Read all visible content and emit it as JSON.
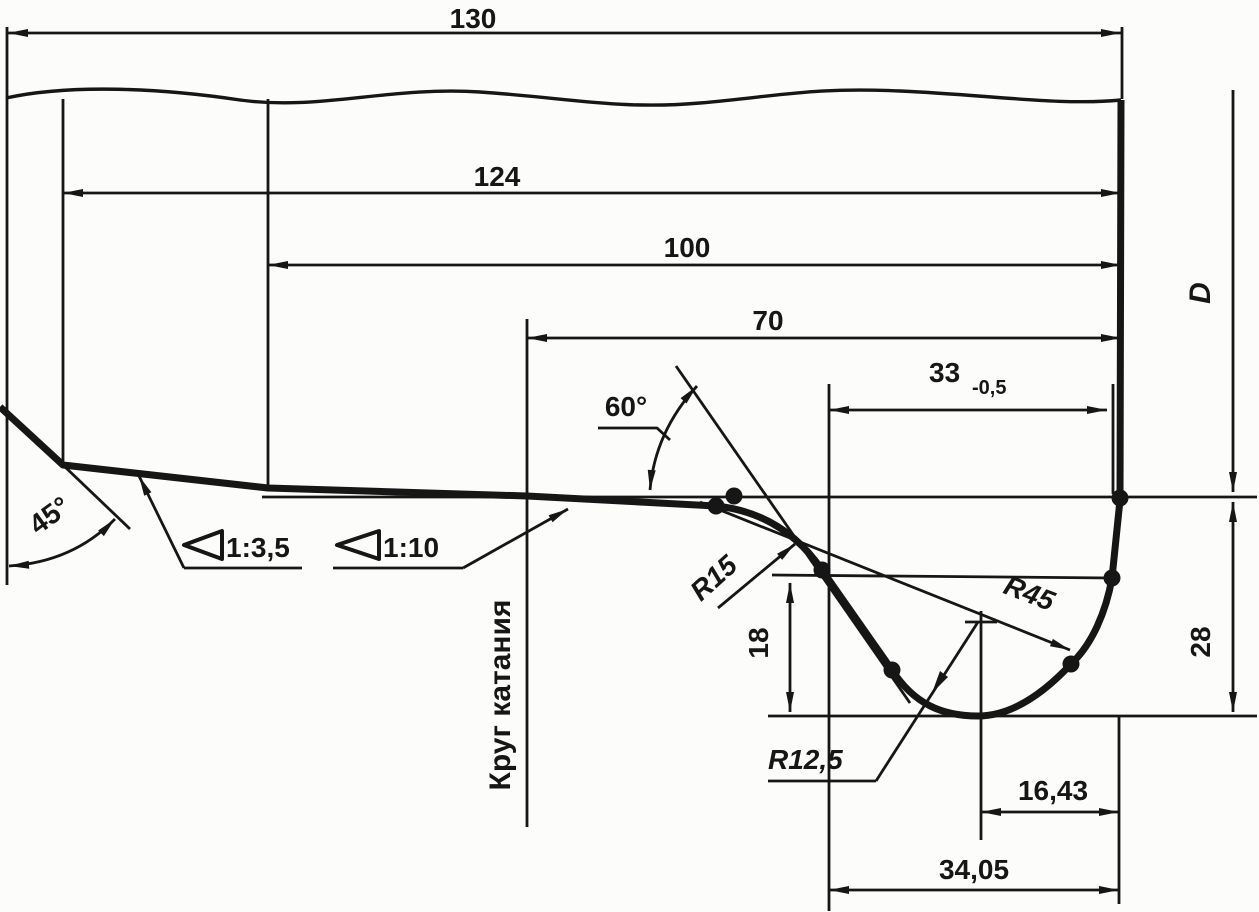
{
  "colors": {
    "ink": "#161616",
    "paper": "#fcfcfa"
  },
  "dimensions": {
    "rim_width_total": "130",
    "width_to_back_chamfer": "124",
    "width_to_outer_taper": "100",
    "rolling_circle_to_inner_face": "70",
    "flange_thickness": "33",
    "flange_thickness_tol": "-0,5",
    "diameter_label": "D",
    "flange_height": "28",
    "flange_gauge_height": "18",
    "tip_to_inner_face": "16,43",
    "tip_center_to_inner_face": "34,05"
  },
  "radii": {
    "tread_to_flange": "R15",
    "flange_back": "R45",
    "flange_tip": "R12,5"
  },
  "angles": {
    "flange_face": "60°",
    "back_chamfer": "45°"
  },
  "tapers": {
    "outer_section": "1:3,5",
    "tread_section": "1:10"
  },
  "labels": {
    "rolling_circle": "Круг катания"
  }
}
